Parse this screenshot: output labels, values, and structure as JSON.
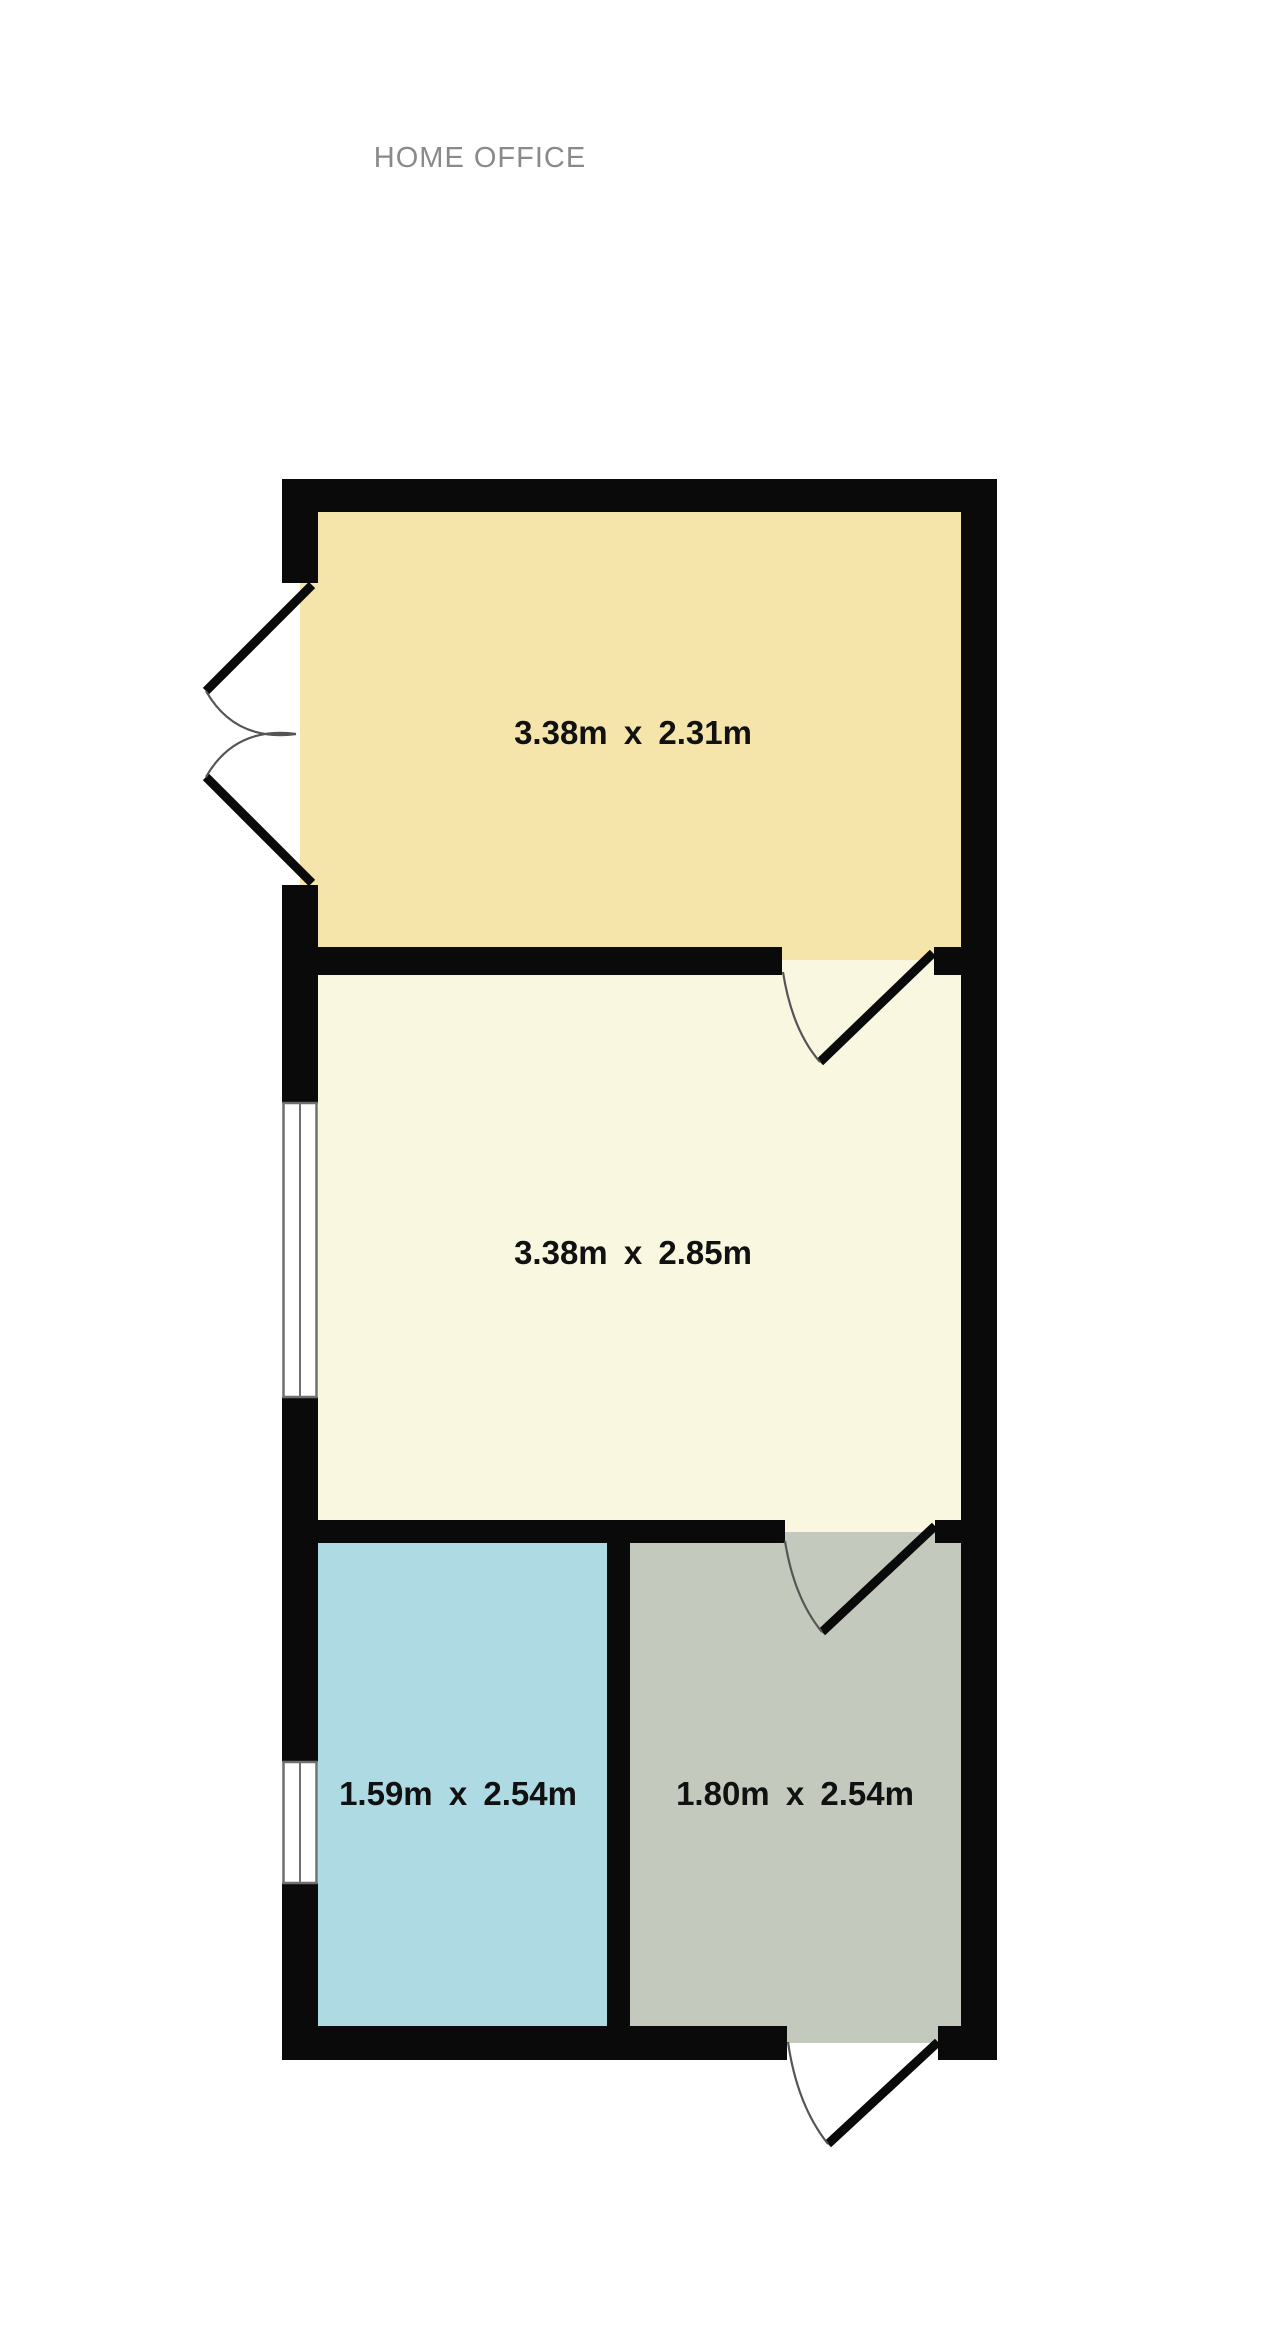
{
  "title": "HOME OFFICE",
  "floorplan": {
    "rooms": [
      {
        "id": "top-room",
        "label": "3.38m x 2.31m",
        "fill": "#f6e5aa"
      },
      {
        "id": "middle-room",
        "label": "3.38m x 2.85m",
        "fill": "#faf7e1"
      },
      {
        "id": "bottom-left-room",
        "label": "1.59m x 2.54m",
        "fill": "#aedae3"
      },
      {
        "id": "bottom-right-room",
        "label": "1.80m x 2.54m",
        "fill": "#c3c9bc"
      }
    ],
    "colors": {
      "background": "#ffffff",
      "wall": "#0a0a0a",
      "title_text": "#8a8a8a",
      "label_text": "#111111",
      "door_arc": "#555555",
      "window_frame": "#6f6f6f",
      "window_fill": "#ffffff"
    }
  }
}
